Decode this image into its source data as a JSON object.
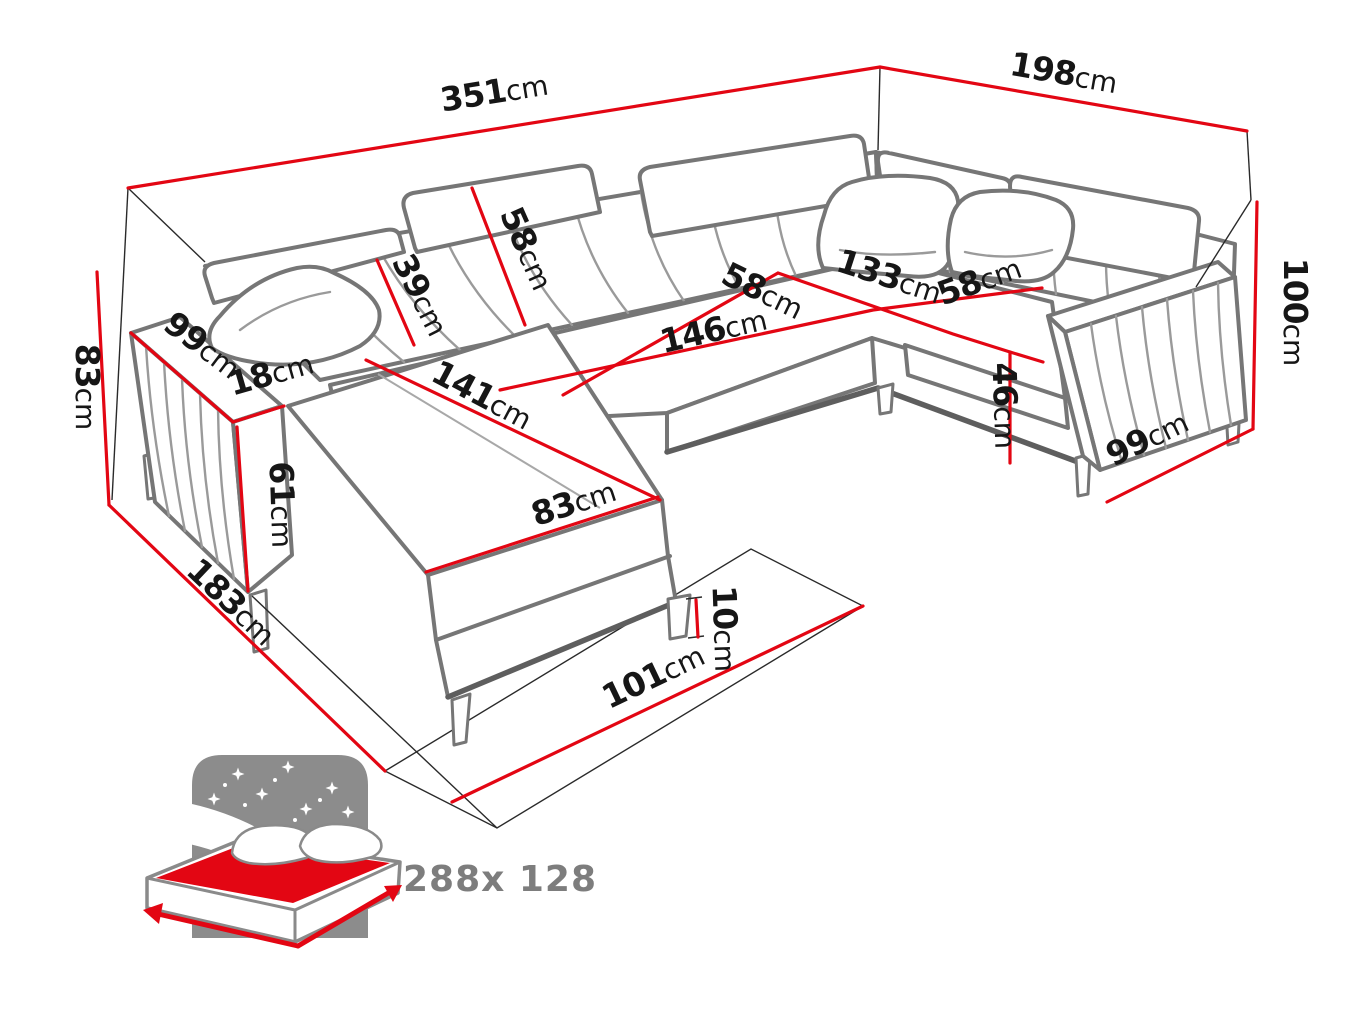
{
  "diagram": {
    "title": "corner-sofa-dimensions",
    "unit": "cm",
    "dimensions": {
      "back_width": {
        "value": "351",
        "unit": "cm"
      },
      "side_depth": {
        "value": "198",
        "unit": "cm"
      },
      "total_height": {
        "value": "100",
        "unit": "cm"
      },
      "left_height": {
        "value": "83",
        "unit": "cm"
      },
      "left_arm_length": {
        "value": "99",
        "unit": "cm"
      },
      "arm_width": {
        "value": "18",
        "unit": "cm"
      },
      "arm_height": {
        "value": "61",
        "unit": "cm"
      },
      "left_side_depth": {
        "value": "183",
        "unit": "cm"
      },
      "backrest_height": {
        "value": "39",
        "unit": "cm"
      },
      "headrest_width": {
        "value": "58",
        "unit": "cm"
      },
      "chaise_length": {
        "value": "141",
        "unit": "cm"
      },
      "chaise_width": {
        "value": "83",
        "unit": "cm"
      },
      "center_seat_length": {
        "value": "146",
        "unit": "cm"
      },
      "left_seat_depth": {
        "value": "58",
        "unit": "cm"
      },
      "corner_width": {
        "value": "133",
        "unit": "cm"
      },
      "right_seat_depth": {
        "value": "58",
        "unit": "cm"
      },
      "seat_height": {
        "value": "46",
        "unit": "cm"
      },
      "right_arm_depth": {
        "value": "99",
        "unit": "cm"
      },
      "leg_height": {
        "value": "10",
        "unit": "cm"
      },
      "front_width": {
        "value": "101",
        "unit": "cm"
      }
    },
    "sleeping_area": {
      "size": "288x 128"
    },
    "colors": {
      "dimension_line": "#e30613",
      "outline": "#767676",
      "icon_gray": "#8c8c8c"
    }
  }
}
